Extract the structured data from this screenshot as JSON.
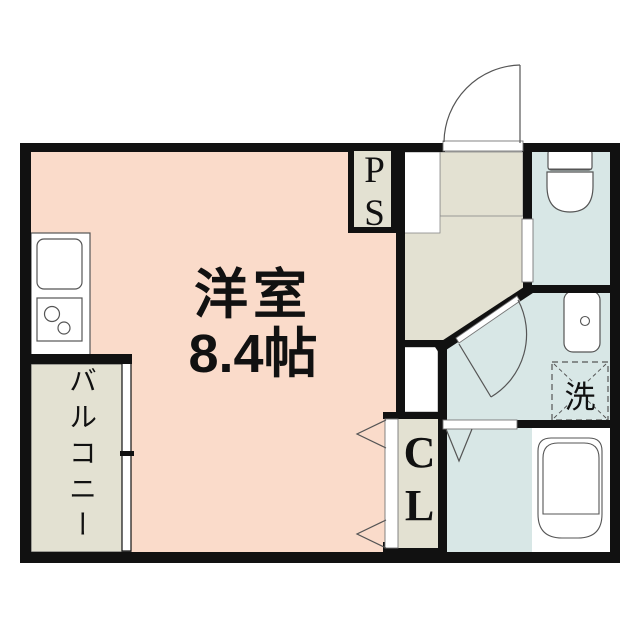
{
  "plan": {
    "rooms": {
      "main_room": {
        "name": "洋室",
        "size": "8.4帖"
      },
      "balcony": {
        "name": "バルコニー"
      },
      "pipe_space": {
        "abbr": "PS"
      },
      "closet": {
        "abbr": "CL"
      },
      "laundry": {
        "symbol": "洗"
      }
    },
    "colors": {
      "room_pink": "#fadbca",
      "hall_beige": "#e3e1d2",
      "wet_blue": "#d8e7e6",
      "wall": "#111111",
      "line": "#555555",
      "ink": "#111111",
      "fixture_white": "#ffffff"
    }
  }
}
